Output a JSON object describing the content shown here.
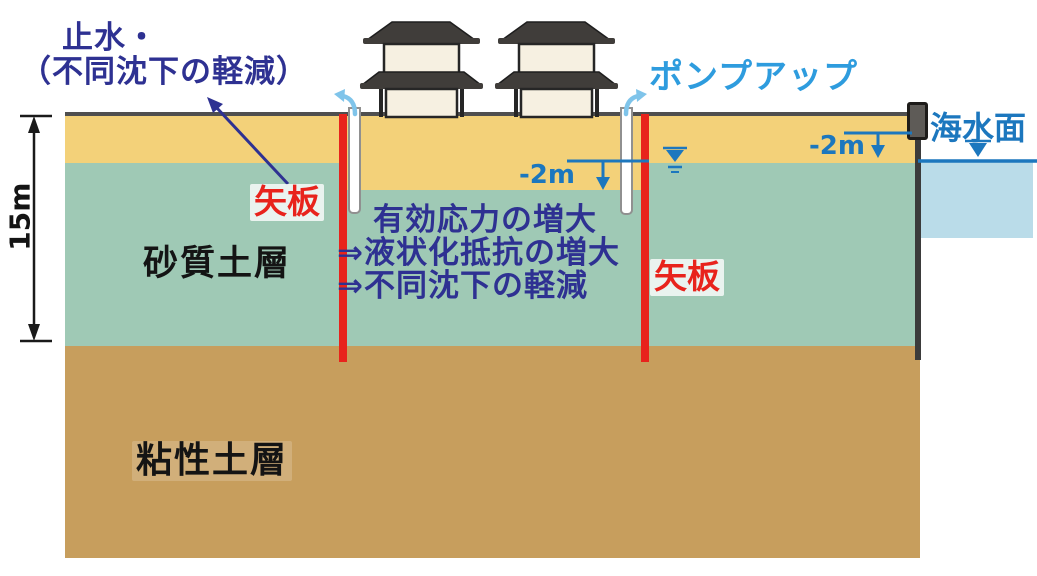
{
  "diagram": {
    "annotations": {
      "waterproofing": {
        "line1": "止水・",
        "line2": "（不同沈下の軽減）"
      },
      "sheet_pile_left": "矢板",
      "sheet_pile_right": "矢板",
      "pump_up": "ポンプアップ",
      "sea_surface": "海水面",
      "drawdown_inner": "-2m",
      "drawdown_sea": "-2m",
      "depth_dimension": "15m",
      "effects": {
        "line1": "有効応力の増大",
        "line2": "⇒液状化抵抗の増大",
        "line3": "⇒不同沈下の軽減"
      }
    },
    "layers": {
      "sandy": "砂質土層",
      "clay": "粘性土層"
    },
    "icons": [
      "building-icon",
      "pump-arrow-left-icon",
      "pump-arrow-right-icon",
      "groundwater-level-icon",
      "sea-level-triangle-icon",
      "dimension-arrow-icon",
      "pointer-arrow-icon",
      "drawdown-arrow-inner-icon",
      "drawdown-arrow-sea-icon",
      "bollard-icon"
    ],
    "colors": {
      "surface_soil_yellow": "#F3D179",
      "sandy_soil_teal": "#9FC9B5",
      "clay_soil_brown": "#C79E5D",
      "sea_light_blue": "#BADCE9",
      "ground_line_gray": "#4F4F4F",
      "sheet_pile_red": "#E8231C",
      "quay_wall_gray": "#3B3B3B",
      "water_blue": "#1C77BE",
      "pump_label_blue": "#2E9CDE",
      "annotation_indigo": "#2E3192",
      "building_roof": "#403D3A",
      "building_wall": "#F6F0E1"
    }
  }
}
